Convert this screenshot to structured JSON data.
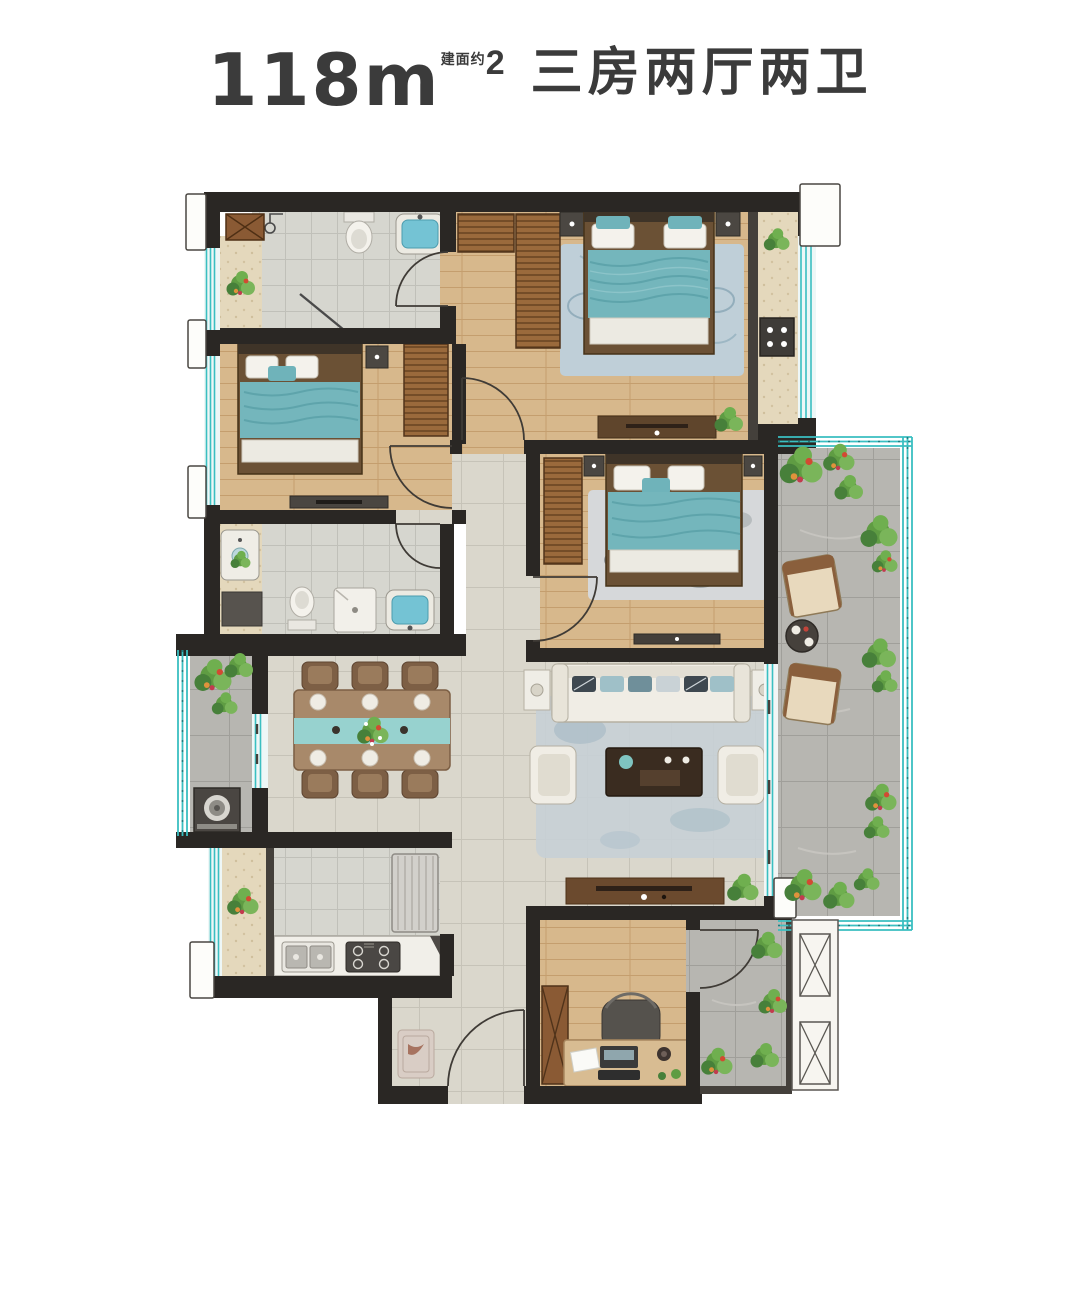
{
  "title": {
    "area_value": "118",
    "area_unit": "m",
    "area_superscript": "2",
    "area_prefix_note": "建面约",
    "layout_label": "三房两厅两卫"
  },
  "plan": {
    "type": "residential-floor-plan",
    "bedrooms": 3,
    "living_rooms": 2,
    "bathrooms": 2,
    "rooms": [
      {
        "id": "master-bedroom"
      },
      {
        "id": "bedroom-2"
      },
      {
        "id": "bedroom-3"
      },
      {
        "id": "bathroom-1"
      },
      {
        "id": "bathroom-2"
      },
      {
        "id": "living-room"
      },
      {
        "id": "dining-room"
      },
      {
        "id": "kitchen"
      },
      {
        "id": "study"
      },
      {
        "id": "entry"
      },
      {
        "id": "left-balcony"
      },
      {
        "id": "right-terrace"
      },
      {
        "id": "garden-patio"
      },
      {
        "id": "ac-platform"
      }
    ]
  },
  "palette": {
    "background": "#ffffff",
    "title_text": "#3b3b3b",
    "wall": "#2a2724",
    "wall_light": "#44403b",
    "wood_floor": "#d7b88c",
    "living_tile": "#dad7cc",
    "bath_tile": "#d6d6cf",
    "balcony_tile": "#b7b6b1",
    "ledge_beige": "#e4d8bc",
    "bed_teal": "#74b6bc",
    "railing_teal": "#3abfc1",
    "wardrobe_brown": "#9a6a3c",
    "sofa_cream": "#f0ede5",
    "table_wood": "#a8896a",
    "runner_teal": "#97d2cf",
    "plant_green": "#5f9c43",
    "accent_red": "#d24a32"
  }
}
